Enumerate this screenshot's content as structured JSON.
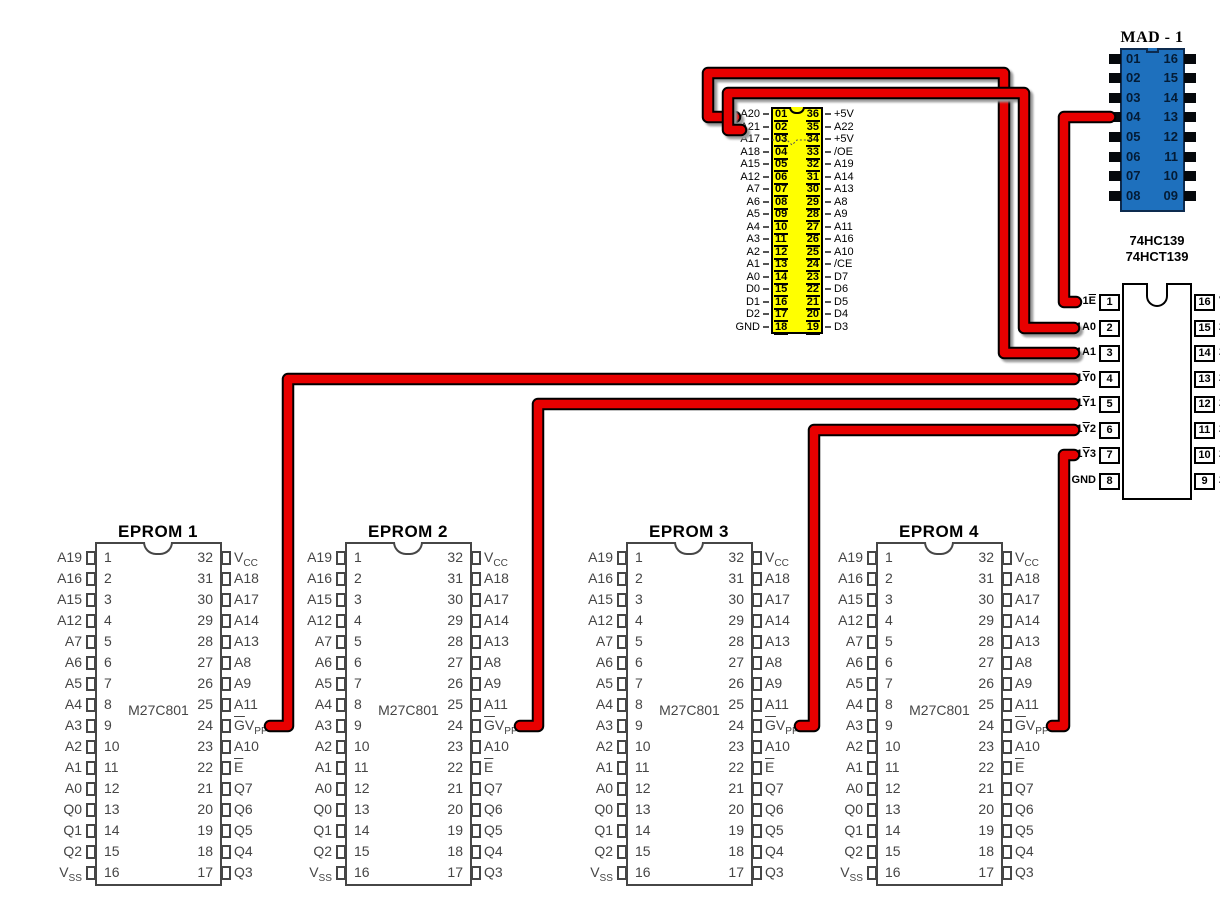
{
  "colors": {
    "wire_red": "#e80000",
    "wire_outline": "#000000",
    "mad_body_blue": "#1e70bd",
    "mad_border": "#0d2b4f",
    "yellow_body": "#ffff00"
  },
  "yellow_chip": {
    "left_pins": [
      {
        "num": "01",
        "label": "A20"
      },
      {
        "num": "02",
        "label": "A21"
      },
      {
        "num": "03",
        "label": "A17"
      },
      {
        "num": "04",
        "label": "A18"
      },
      {
        "num": "05",
        "label": "A15"
      },
      {
        "num": "06",
        "label": "A12"
      },
      {
        "num": "07",
        "label": "A7"
      },
      {
        "num": "08",
        "label": "A6"
      },
      {
        "num": "09",
        "label": "A5"
      },
      {
        "num": "10",
        "label": "A4"
      },
      {
        "num": "11",
        "label": "A3"
      },
      {
        "num": "12",
        "label": "A2"
      },
      {
        "num": "13",
        "label": "A1"
      },
      {
        "num": "14",
        "label": "A0"
      },
      {
        "num": "15",
        "label": "D0"
      },
      {
        "num": "16",
        "label": "D1"
      },
      {
        "num": "17",
        "label": "D2"
      },
      {
        "num": "18",
        "label": "GND"
      }
    ],
    "right_pins": [
      {
        "num": "36",
        "label": "+5V"
      },
      {
        "num": "35",
        "label": "A22"
      },
      {
        "num": "34",
        "label": "+5V"
      },
      {
        "num": "33",
        "label": "/OE"
      },
      {
        "num": "32",
        "label": "A19"
      },
      {
        "num": "31",
        "label": "A14"
      },
      {
        "num": "30",
        "label": "A13"
      },
      {
        "num": "29",
        "label": "A8"
      },
      {
        "num": "28",
        "label": "A9"
      },
      {
        "num": "27",
        "label": "A11"
      },
      {
        "num": "26",
        "label": "A16"
      },
      {
        "num": "25",
        "label": "A10"
      },
      {
        "num": "24",
        "label": "/CE"
      },
      {
        "num": "23",
        "label": "D7"
      },
      {
        "num": "22",
        "label": "D6"
      },
      {
        "num": "21",
        "label": "D5"
      },
      {
        "num": "20",
        "label": "D4"
      },
      {
        "num": "19",
        "label": "D3"
      }
    ]
  },
  "mad1": {
    "title": "MAD - 1",
    "left_pins": [
      "01",
      "02",
      "03",
      "04",
      "05",
      "06",
      "07",
      "08"
    ],
    "right_pins": [
      "16",
      "15",
      "14",
      "13",
      "12",
      "11",
      "10",
      "09"
    ]
  },
  "decoder": {
    "title_line1": "74HC139",
    "title_line2": "74HCT139",
    "left_pins": [
      {
        "label": "1^E^",
        "num": "1"
      },
      {
        "label": "1A0",
        "num": "2"
      },
      {
        "label": "1A1",
        "num": "3"
      },
      {
        "label": "1^Y^0",
        "num": "4"
      },
      {
        "label": "1^Y^1",
        "num": "5"
      },
      {
        "label": "1^Y^2",
        "num": "6"
      },
      {
        "label": "1^Y^3",
        "num": "7"
      },
      {
        "label": "GND",
        "num": "8"
      }
    ],
    "right_pins": [
      {
        "num": "16",
        "label": "V"
      },
      {
        "num": "15",
        "label": "2"
      },
      {
        "num": "14",
        "label": "2"
      },
      {
        "num": "13",
        "label": "2"
      },
      {
        "num": "12",
        "label": "2"
      },
      {
        "num": "11",
        "label": "2"
      },
      {
        "num": "10",
        "label": "2"
      },
      {
        "num": "9",
        "label": "2"
      }
    ]
  },
  "eprom_pins": {
    "left": [
      {
        "label": "A19",
        "num": "1"
      },
      {
        "label": "A16",
        "num": "2"
      },
      {
        "label": "A15",
        "num": "3"
      },
      {
        "label": "A12",
        "num": "4"
      },
      {
        "label": "A7",
        "num": "5"
      },
      {
        "label": "A6",
        "num": "6"
      },
      {
        "label": "A5",
        "num": "7"
      },
      {
        "label": "A4",
        "num": "8"
      },
      {
        "label": "A3",
        "num": "9"
      },
      {
        "label": "A2",
        "num": "10"
      },
      {
        "label": "A1",
        "num": "11"
      },
      {
        "label": "A0",
        "num": "12"
      },
      {
        "label": "Q0",
        "num": "13"
      },
      {
        "label": "Q1",
        "num": "14"
      },
      {
        "label": "Q2",
        "num": "15"
      },
      {
        "label": "V~SS~",
        "num": "16"
      }
    ],
    "right": [
      {
        "num": "32",
        "label": "V~CC~"
      },
      {
        "num": "31",
        "label": "A18"
      },
      {
        "num": "30",
        "label": "A17"
      },
      {
        "num": "29",
        "label": "A14"
      },
      {
        "num": "28",
        "label": "A13"
      },
      {
        "num": "27",
        "label": "A8"
      },
      {
        "num": "26",
        "label": "A9"
      },
      {
        "num": "25",
        "label": "A11"
      },
      {
        "num": "24",
        "label": "^G^V~PP~"
      },
      {
        "num": "23",
        "label": "A10"
      },
      {
        "num": "22",
        "label": "^E^"
      },
      {
        "num": "21",
        "label": "Q7"
      },
      {
        "num": "20",
        "label": "Q6"
      },
      {
        "num": "19",
        "label": "Q5"
      },
      {
        "num": "18",
        "label": "Q4"
      },
      {
        "num": "17",
        "label": "Q3"
      }
    ]
  },
  "eproms": [
    {
      "title": "EPROM 1",
      "part": "M27C801"
    },
    {
      "title": "EPROM 2",
      "part": "M27C801"
    },
    {
      "title": "EPROM 3",
      "part": "M27C801"
    },
    {
      "title": "EPROM 4",
      "part": "M27C801"
    }
  ],
  "wires": [
    {
      "name": "wire-a20-to-1a1",
      "from": "yellow chip pin 01 A20",
      "to": "74HC139 pin 3 1A1",
      "shadow": true,
      "points": [
        [
          735,
          117
        ],
        [
          708,
          117
        ],
        [
          708,
          73
        ],
        [
          1004,
          73
        ],
        [
          1004,
          353
        ],
        [
          1074,
          353
        ]
      ]
    },
    {
      "name": "wire-a21-to-1a0",
      "from": "yellow chip pin 02 A21",
      "to": "74HC139 pin 2 1A0",
      "shadow": true,
      "points": [
        [
          741,
          130
        ],
        [
          728,
          130
        ],
        [
          728,
          93
        ],
        [
          1024,
          93
        ],
        [
          1024,
          328
        ],
        [
          1074,
          328
        ]
      ]
    },
    {
      "name": "wire-mad1-pin04-to-1e",
      "from": "MAD-1 pin 04",
      "to": "74HC139 pin 1 1E",
      "shadow": false,
      "points": [
        [
          1110,
          117
        ],
        [
          1064,
          117
        ],
        [
          1064,
          302
        ],
        [
          1076,
          302
        ]
      ]
    },
    {
      "name": "wire-1y0-to-eprom1-gvpp",
      "from": "74HC139 pin 4 1Y0",
      "to": "EPROM 1 pin 24 GVPP",
      "shadow": false,
      "points": [
        [
          1074,
          379
        ],
        [
          288,
          379
        ],
        [
          288,
          726
        ],
        [
          270,
          726
        ]
      ]
    },
    {
      "name": "wire-1y1-to-eprom2-gvpp",
      "from": "74HC139 pin 5 1Y1",
      "to": "EPROM 2 pin 24 GVPP",
      "shadow": false,
      "points": [
        [
          1074,
          404
        ],
        [
          538,
          404
        ],
        [
          538,
          726
        ],
        [
          520,
          726
        ]
      ]
    },
    {
      "name": "wire-1y2-to-eprom3-gvpp",
      "from": "74HC139 pin 6 1Y2",
      "to": "EPROM 3 pin 24 GVPP",
      "shadow": false,
      "points": [
        [
          1074,
          430
        ],
        [
          814,
          430
        ],
        [
          814,
          726
        ],
        [
          800,
          726
        ]
      ]
    },
    {
      "name": "wire-1y3-to-eprom4-gvpp",
      "from": "74HC139 pin 7 1Y3",
      "to": "EPROM 4 pin 24 GVPP",
      "shadow": false,
      "points": [
        [
          1074,
          455
        ],
        [
          1064,
          455
        ],
        [
          1064,
          726
        ],
        [
          1052,
          726
        ]
      ]
    }
  ]
}
